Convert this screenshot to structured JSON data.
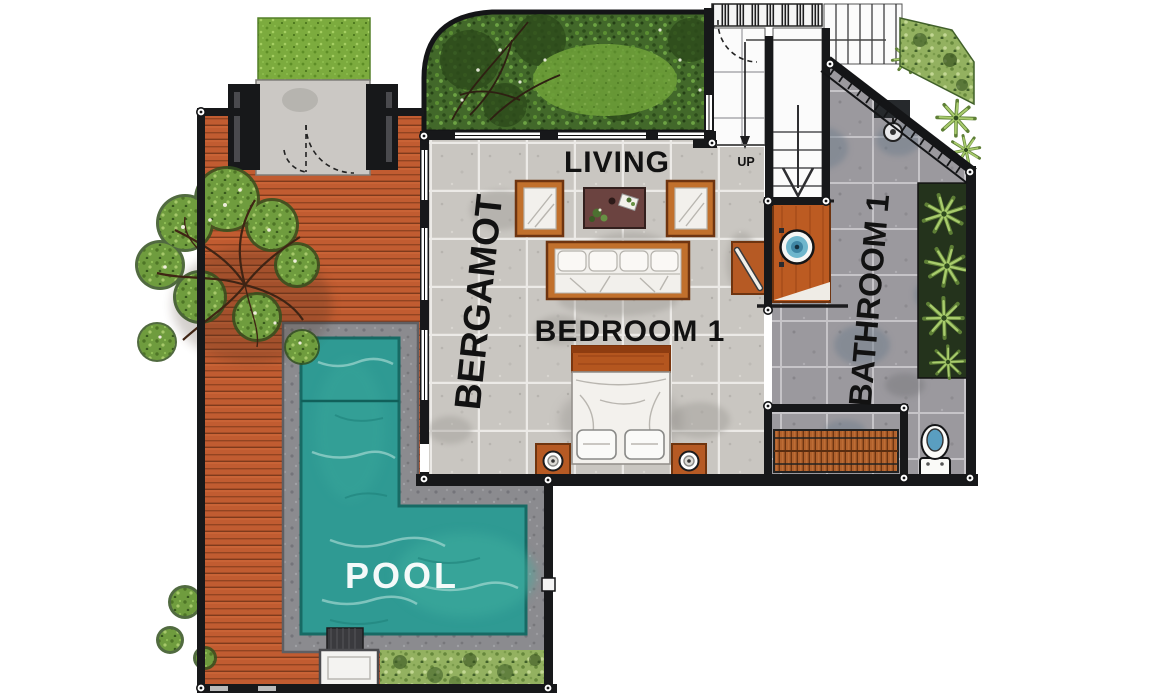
{
  "plan": {
    "name": "Bergamot villa ground-floor plan with pool",
    "labels": {
      "living": "LIVING",
      "pavilion": "BERGAMOT",
      "bedroom": "BEDROOM 1",
      "bathroom": "BATHROOM 1",
      "pool": "POOL",
      "stairs_up": "UP"
    },
    "colors": {
      "wall": "#17181a",
      "deck_wood": "#c15c31",
      "pool_water": "#2f9a93",
      "pool_surround": "#8b8b8f",
      "living_floor": "#c9c6c1",
      "bathroom_floor": "#9b999e",
      "garden_green": "#42682a",
      "entry_grass": "#7cab3e",
      "hedge_green": "#93b160",
      "furniture_wood": "#c1702c",
      "coffee_table": "#6b4340",
      "cushion_white": "#f2f0ec",
      "basin_blue": "#6fb6cc",
      "label_text": "#121212",
      "pool_label_text": "#ffffff"
    }
  }
}
